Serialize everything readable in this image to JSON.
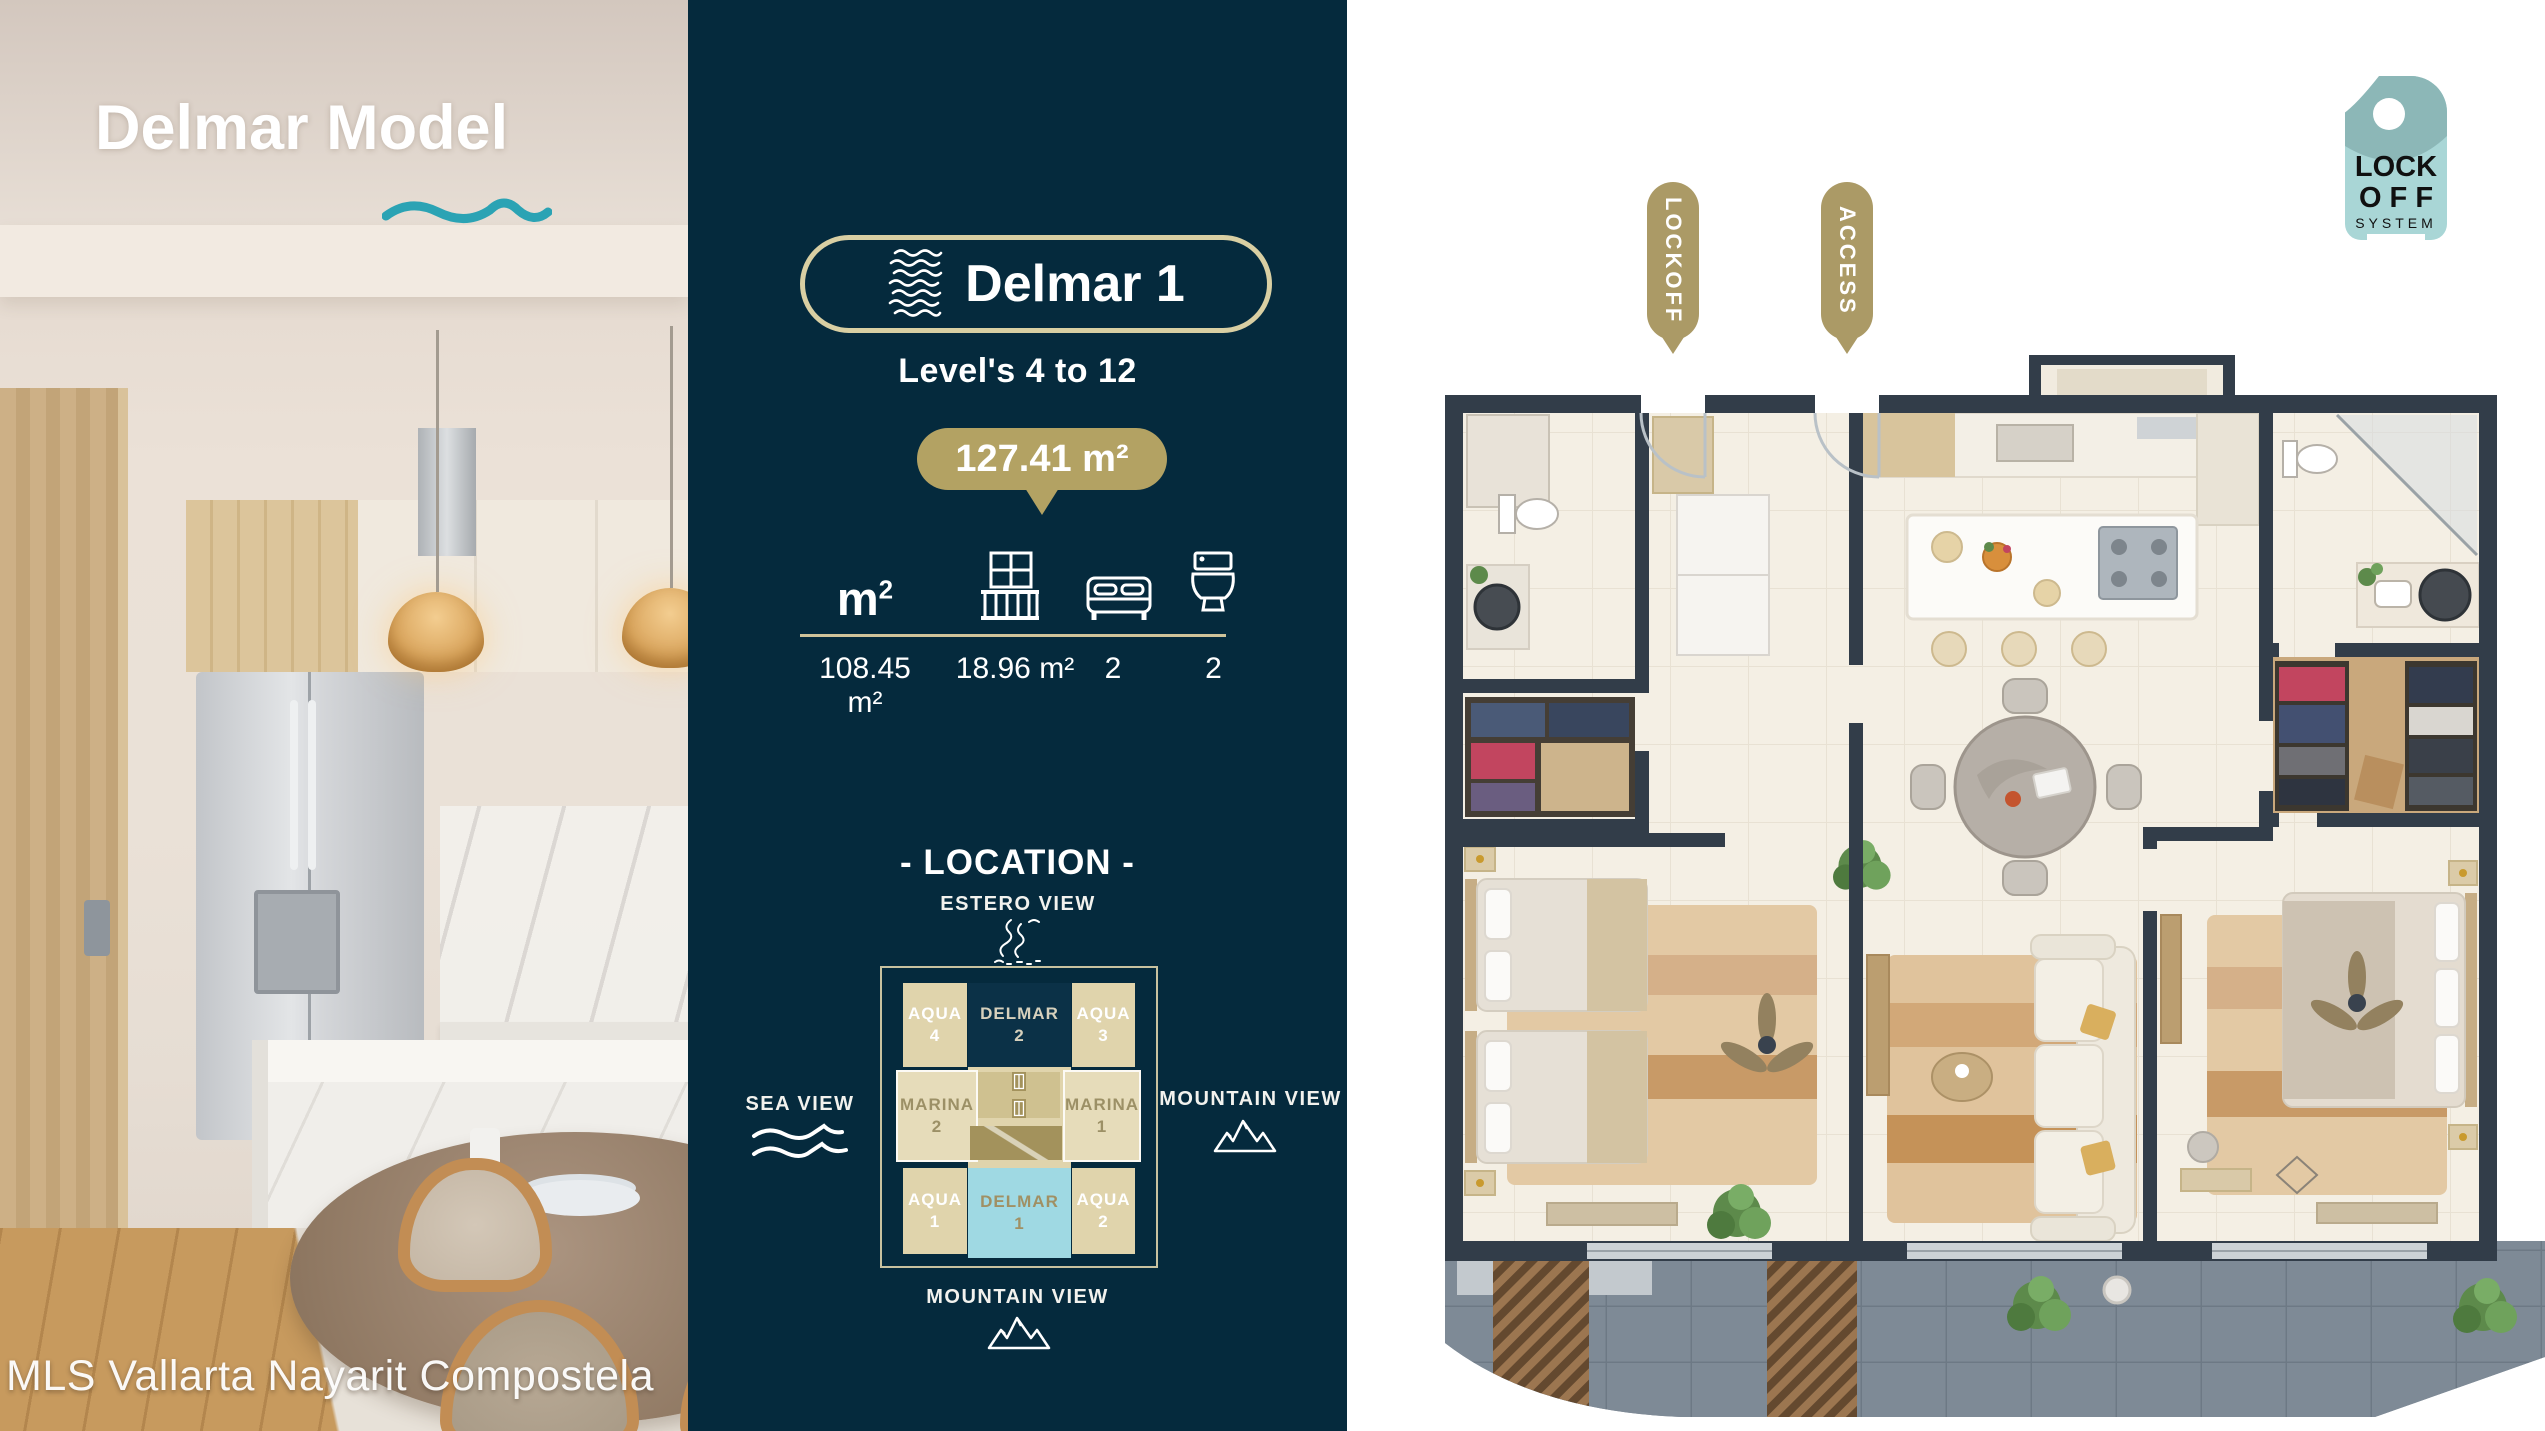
{
  "left_panel": {
    "title": "Delmar Model",
    "watermark": "MLS Vallarta Nayarit Compostela"
  },
  "info_panel": {
    "unit_name": "Delmar 1",
    "levels": "Level's 4 to 12",
    "total_area": "127.41 m²",
    "stats": {
      "area_label_base": "m",
      "area_label_sup": "2",
      "interior_area": "108.45 m²",
      "balcony_area": "18.96 m²",
      "bedrooms": "2",
      "bathrooms": "2"
    },
    "location": {
      "heading": "- LOCATION -",
      "estero_view": "ESTERO VIEW",
      "sea_view": "SEA VIEW",
      "mountain_view_right": "MOUNTAIN VIEW",
      "mountain_view_bottom": "MOUNTAIN VIEW",
      "grid": {
        "top": [
          {
            "name": "AQUA",
            "num": "4"
          },
          {
            "name": "DELMAR",
            "num": "2"
          },
          {
            "name": "AQUA",
            "num": "3"
          }
        ],
        "middle": [
          {
            "name": "MARINA",
            "num": "2"
          },
          {
            "name": "MARINA",
            "num": "1"
          }
        ],
        "bottom": [
          {
            "name": "AQUA",
            "num": "1"
          },
          {
            "name": "DELMAR",
            "num": "1"
          },
          {
            "name": "AQUA",
            "num": "2"
          }
        ]
      }
    }
  },
  "plan_panel": {
    "lockoff_tag": "LOCKOFF",
    "access_tag": "ACCESS",
    "logo": {
      "line1": "LOCK",
      "line2": "O F F",
      "line3": "SYSTEM"
    }
  },
  "colors": {
    "navy": "#052a3d",
    "gold": "#b3a263",
    "tan_border": "#d9cfa3",
    "cell_tan": "#e0d4ac",
    "highlight_cyan": "#9fd9e3",
    "wave_teal": "#2ba3b4",
    "wall": "#323d49"
  }
}
